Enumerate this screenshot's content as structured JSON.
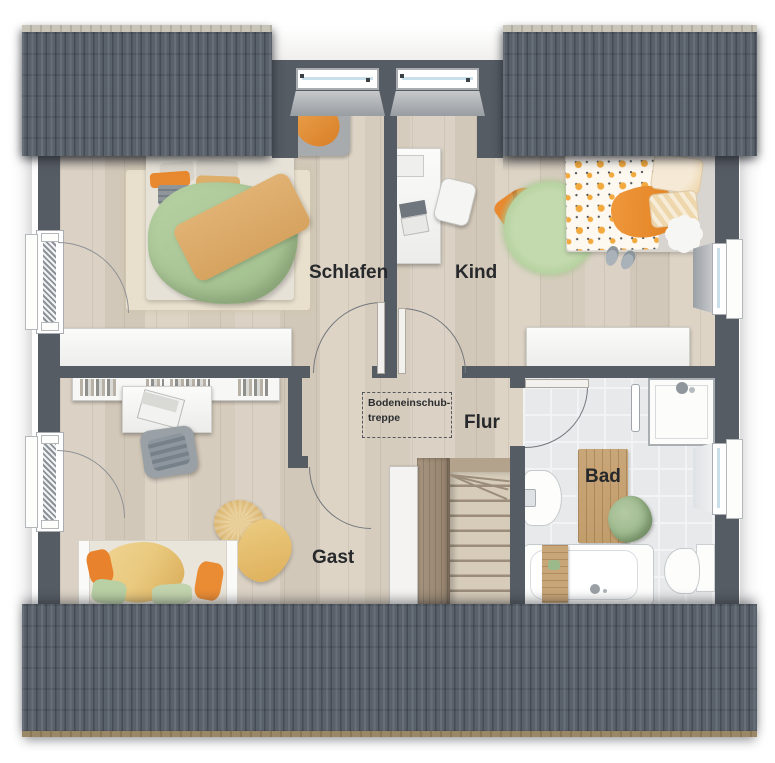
{
  "floorplan": {
    "rooms": {
      "schlafen": "Schlafen",
      "kind": "Kind",
      "flur": "Flur",
      "gast": "Gast",
      "bad": "Bad"
    },
    "annotation": {
      "attic_stairs_line1": "Bodeneinschub-",
      "attic_stairs_line2": "treppe"
    },
    "colors": {
      "roof": "#59616b",
      "wall": "#565c64",
      "wood_floor": "#d7cdc0",
      "tile_floor": "#e7e9ea",
      "accent_orange": "#e8892f",
      "accent_green": "#aecb96",
      "accent_yellow": "#e9c97e",
      "wood_furniture": "#c9a678"
    }
  }
}
